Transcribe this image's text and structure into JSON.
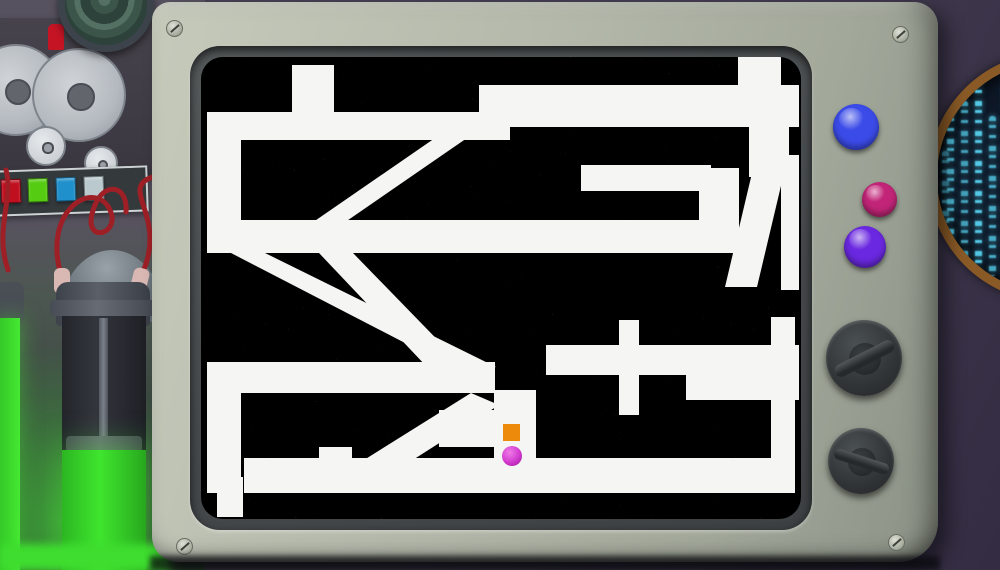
{
  "scene_title": "maze game on retro tv monitor",
  "tv": {
    "frame_color": "#b3b8aa",
    "bezel_color": "#45494b",
    "screw_count": 4,
    "buttons": [
      {
        "name": "blue-button",
        "color": "#3b4be8"
      },
      {
        "name": "pink-button",
        "color": "#c22578"
      },
      {
        "name": "purple-button",
        "color": "#6a28e0"
      }
    ],
    "knobs": [
      {
        "name": "upper-knob"
      },
      {
        "name": "lower-knob"
      }
    ]
  },
  "maze": {
    "screen_w": 600,
    "screen_h": 462,
    "wall_noise_base": "#404040",
    "path_color": "#f5f5f3",
    "player": {
      "shape": "ball",
      "color": "#d43fd0",
      "cx": 311,
      "cy": 399,
      "r": 10
    },
    "marker": {
      "shape": "square",
      "color": "#ed8a0c",
      "x": 302,
      "y": 367,
      "size": 17
    },
    "paths": {
      "rects": [
        [
          91,
          8,
          42,
          47
        ],
        [
          537,
          0,
          43,
          30
        ],
        [
          6,
          55,
          303,
          28
        ],
        [
          278,
          28,
          320,
          42
        ],
        [
          548,
          68,
          40,
          52
        ],
        [
          580,
          98,
          18,
          135
        ],
        [
          6,
          83,
          34,
          85
        ],
        [
          6,
          163,
          532,
          33
        ],
        [
          380,
          108,
          130,
          26
        ],
        [
          498,
          111,
          40,
          56
        ],
        [
          6,
          305,
          288,
          31
        ],
        [
          345,
          288,
          253,
          30
        ],
        [
          485,
          315,
          113,
          28
        ],
        [
          418,
          263,
          20,
          95
        ],
        [
          6,
          336,
          34,
          100
        ],
        [
          118,
          390,
          33,
          46
        ],
        [
          43,
          401,
          547,
          35
        ],
        [
          570,
          260,
          24,
          176
        ],
        [
          16,
          420,
          26,
          40
        ],
        [
          293,
          333,
          42,
          68
        ],
        [
          238,
          353,
          57,
          37
        ]
      ],
      "polys": [
        [
          105,
          170,
          137,
          170,
          282,
          70,
          250,
          70
        ],
        [
          30,
          196,
          64,
          196,
          295,
          310,
          262,
          316
        ],
        [
          118,
          196,
          152,
          196,
          258,
          305,
          226,
          310
        ],
        [
          524,
          230,
          556,
          95,
          588,
          95,
          556,
          230
        ],
        [
          155,
          408,
          185,
          420,
          298,
          348,
          270,
          336
        ]
      ]
    }
  },
  "lab": {
    "panel_buttons": [
      "#c01020",
      "#55cc11",
      "#2090cc",
      "#b9c9cd"
    ],
    "tape_reels": 4,
    "record_button_color": "#c51424",
    "wire_color": "#9e1f26",
    "canister_glow_color": "#3fe52e"
  },
  "porthole": {
    "rim_color": "#8a5a26",
    "glyph_color": "#57d0ee"
  }
}
